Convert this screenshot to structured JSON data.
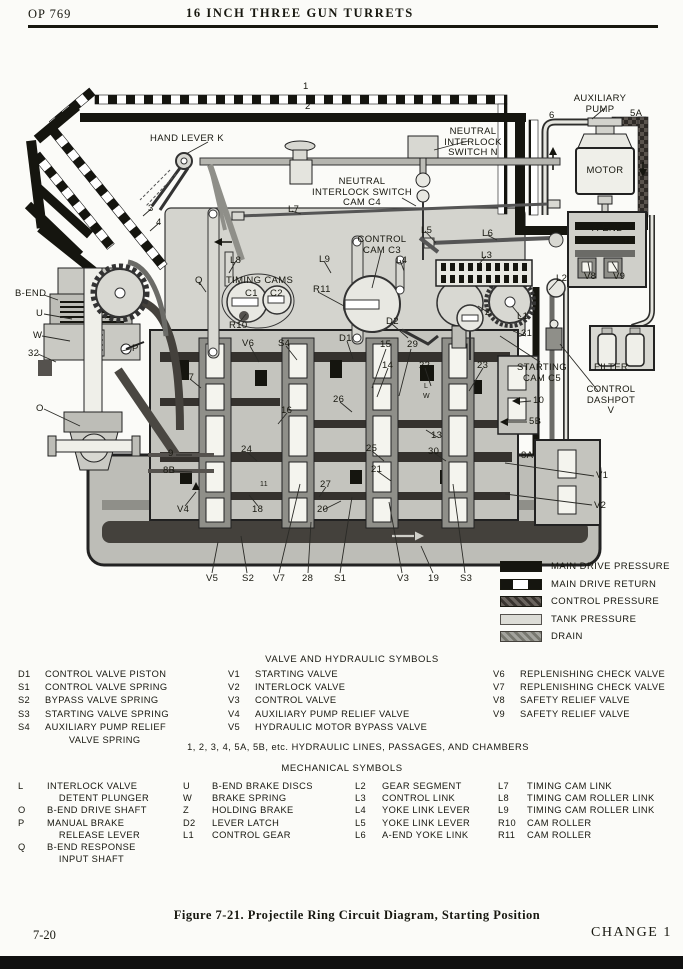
{
  "header": {
    "op_number": "OP 769",
    "title": "16 INCH THREE GUN TURRETS"
  },
  "diagram": {
    "labels": [
      {
        "id": "line-1",
        "t": "1",
        "x": 303,
        "y": 82
      },
      {
        "id": "line-2",
        "t": "2",
        "x": 305,
        "y": 102
      },
      {
        "id": "auxiliary-pump",
        "t": "AUXILIARY\nPUMP",
        "x": 600,
        "y": 94,
        "c": 1
      },
      {
        "id": "line-5a",
        "t": "5A",
        "x": 630,
        "y": 109
      },
      {
        "id": "line-6",
        "t": "6",
        "x": 549,
        "y": 111
      },
      {
        "id": "motor",
        "t": "MOTOR",
        "x": 605,
        "y": 166,
        "c": 1
      },
      {
        "id": "hand-lever-k",
        "t": "HAND LEVER K",
        "x": 150,
        "y": 134
      },
      {
        "id": "neutral-interlock-switch-n",
        "t": "NEUTRAL\nINTERLOCK\nSWITCH N",
        "x": 473,
        "y": 127,
        "c": 1
      },
      {
        "id": "neutral-interlock-switch-cam-c4",
        "t": "NEUTRAL\nINTERLOCK SWITCH\nCAM C4",
        "x": 362,
        "y": 177,
        "c": 1
      },
      {
        "id": "l7",
        "t": "L7",
        "x": 288,
        "y": 205
      },
      {
        "id": "line-3",
        "t": "3",
        "x": 148,
        "y": 204
      },
      {
        "id": "line-4",
        "t": "4",
        "x": 156,
        "y": 218
      },
      {
        "id": "l5",
        "t": "L5",
        "x": 421,
        "y": 226
      },
      {
        "id": "l6",
        "t": "L6",
        "x": 482,
        "y": 229
      },
      {
        "id": "control-cam-c3",
        "t": "CONTROL\nCAM C3",
        "x": 382,
        "y": 235,
        "c": 1
      },
      {
        "id": "l4",
        "t": "L4",
        "x": 396,
        "y": 256
      },
      {
        "id": "a-end",
        "t": "A-END",
        "x": 592,
        "y": 224
      },
      {
        "id": "h",
        "t": "H",
        "x": 624,
        "y": 237
      },
      {
        "id": "l8",
        "t": "L8",
        "x": 230,
        "y": 256
      },
      {
        "id": "l9",
        "t": "L9",
        "x": 319,
        "y": 255
      },
      {
        "id": "l3",
        "t": "L3",
        "x": 481,
        "y": 251
      },
      {
        "id": "b-end",
        "t": "B-END",
        "x": 15,
        "y": 289
      },
      {
        "id": "timing-cams",
        "t": "TIMING CAMS",
        "x": 226,
        "y": 276
      },
      {
        "id": "c1",
        "t": "C1",
        "x": 245,
        "y": 289
      },
      {
        "id": "c2",
        "t": "C2",
        "x": 270,
        "y": 289
      },
      {
        "id": "r11",
        "t": "R11",
        "x": 313,
        "y": 285
      },
      {
        "id": "q",
        "t": "Q",
        "x": 195,
        "y": 276
      },
      {
        "id": "r10",
        "t": "R10",
        "x": 229,
        "y": 321
      },
      {
        "id": "d2",
        "t": "D2",
        "x": 386,
        "y": 317
      },
      {
        "id": "l2",
        "t": "L2",
        "x": 556,
        "y": 274
      },
      {
        "id": "z",
        "t": "Z",
        "x": 485,
        "y": 308
      },
      {
        "id": "l1",
        "t": "L1",
        "x": 517,
        "y": 312
      },
      {
        "id": "v8",
        "t": "V8",
        "x": 584,
        "y": 272
      },
      {
        "id": "v9",
        "t": "V9",
        "x": 613,
        "y": 272
      },
      {
        "id": "u",
        "t": "U",
        "x": 36,
        "y": 309
      },
      {
        "id": "w",
        "t": "W",
        "x": 33,
        "y": 331
      },
      {
        "id": "num-32",
        "t": "32",
        "x": 28,
        "y": 349
      },
      {
        "id": "p",
        "t": "P",
        "x": 132,
        "y": 344
      },
      {
        "id": "o",
        "t": "O",
        "x": 36,
        "y": 404
      },
      {
        "id": "v6",
        "t": "V6",
        "x": 242,
        "y": 339
      },
      {
        "id": "s4",
        "t": "S4",
        "x": 278,
        "y": 339
      },
      {
        "id": "d1",
        "t": "D1",
        "x": 339,
        "y": 334
      },
      {
        "id": "num-15",
        "t": "15",
        "x": 380,
        "y": 340
      },
      {
        "id": "num-29",
        "t": "29",
        "x": 407,
        "y": 340
      },
      {
        "id": "num-14",
        "t": "14",
        "x": 382,
        "y": 361
      },
      {
        "id": "num-22",
        "t": "22",
        "x": 419,
        "y": 361
      },
      {
        "id": "num-23",
        "t": "23",
        "x": 477,
        "y": 361
      },
      {
        "id": "num-31",
        "t": "31",
        "x": 521,
        "y": 329
      },
      {
        "id": "starting-cam-c5",
        "t": "STARTING\nCAM C5",
        "x": 542,
        "y": 363,
        "c": 1
      },
      {
        "id": "filter",
        "t": "FILTER",
        "x": 594,
        "y": 363
      },
      {
        "id": "control-dashpot-v",
        "t": "CONTROL\nDASHPOT\nV",
        "x": 611,
        "y": 385,
        "c": 1
      },
      {
        "id": "num-26",
        "t": "26",
        "x": 333,
        "y": 395
      },
      {
        "id": "num-16",
        "t": "16",
        "x": 281,
        "y": 406
      },
      {
        "id": "num-10",
        "t": "10",
        "x": 533,
        "y": 396
      },
      {
        "id": "boxed-l",
        "t": "L",
        "x": 424,
        "y": 383,
        "s": 1
      },
      {
        "id": "boxed-w",
        "t": "W",
        "x": 423,
        "y": 393,
        "s": 1
      },
      {
        "id": "num-13",
        "t": "13",
        "x": 431,
        "y": 431
      },
      {
        "id": "line-5b",
        "t": "5B",
        "x": 529,
        "y": 417
      },
      {
        "id": "num-24",
        "t": "24",
        "x": 241,
        "y": 445
      },
      {
        "id": "num-25",
        "t": "25",
        "x": 366,
        "y": 444
      },
      {
        "id": "num-30",
        "t": "30",
        "x": 428,
        "y": 447
      },
      {
        "id": "num-21",
        "t": "21",
        "x": 371,
        "y": 465
      },
      {
        "id": "line-8a",
        "t": "8A",
        "x": 521,
        "y": 451
      },
      {
        "id": "v1",
        "t": "V1",
        "x": 596,
        "y": 471
      },
      {
        "id": "v2",
        "t": "V2",
        "x": 594,
        "y": 501
      },
      {
        "id": "num-17",
        "t": "17",
        "x": 183,
        "y": 373
      },
      {
        "id": "line-9",
        "t": "9",
        "x": 168,
        "y": 449
      },
      {
        "id": "line-8b",
        "t": "8B",
        "x": 163,
        "y": 466
      },
      {
        "id": "v4",
        "t": "V4",
        "x": 177,
        "y": 505
      },
      {
        "id": "num-18",
        "t": "18",
        "x": 252,
        "y": 505
      },
      {
        "id": "num-11",
        "t": "11",
        "x": 260,
        "y": 481,
        "s": 1
      },
      {
        "id": "num-27",
        "t": "27",
        "x": 320,
        "y": 480
      },
      {
        "id": "num-20",
        "t": "20",
        "x": 317,
        "y": 505
      },
      {
        "id": "v5",
        "t": "V5",
        "x": 206,
        "y": 574
      },
      {
        "id": "s2",
        "t": "S2",
        "x": 242,
        "y": 574
      },
      {
        "id": "v7",
        "t": "V7",
        "x": 273,
        "y": 574
      },
      {
        "id": "num-28",
        "t": "28",
        "x": 302,
        "y": 574
      },
      {
        "id": "s1",
        "t": "S1",
        "x": 334,
        "y": 574
      },
      {
        "id": "v3",
        "t": "V3",
        "x": 397,
        "y": 574
      },
      {
        "id": "num-19",
        "t": "19",
        "x": 428,
        "y": 574
      },
      {
        "id": "s3",
        "t": "S3",
        "x": 460,
        "y": 574
      }
    ]
  },
  "legend": {
    "items": [
      {
        "key": "main-drive-pressure",
        "label": "MAIN DRIVE PRESSURE"
      },
      {
        "key": "main-drive-return",
        "label": "MAIN DRIVE RETURN"
      },
      {
        "key": "control-pressure",
        "label": "CONTROL PRESSURE"
      },
      {
        "key": "tank-pressure",
        "label": "TANK PRESSURE"
      },
      {
        "key": "drain",
        "label": "DRAIN"
      }
    ]
  },
  "valve_symbols": {
    "heading": "VALVE AND HYDRAULIC SYMBOLS",
    "col1": [
      {
        "code": "D1",
        "desc": "CONTROL VALVE PISTON"
      },
      {
        "code": "S1",
        "desc": "CONTROL VALVE SPRING"
      },
      {
        "code": "S2",
        "desc": "BYPASS VALVE SPRING"
      },
      {
        "code": "S3",
        "desc": "STARTING VALVE SPRING"
      },
      {
        "code": "S4",
        "desc": "AUXILIARY PUMP RELIEF\n        VALVE SPRING"
      }
    ],
    "col2": [
      {
        "code": "V1",
        "desc": "STARTING VALVE"
      },
      {
        "code": "V2",
        "desc": "INTERLOCK VALVE"
      },
      {
        "code": "V3",
        "desc": "CONTROL VALVE"
      },
      {
        "code": "V4",
        "desc": "AUXILIARY PUMP RELIEF VALVE"
      },
      {
        "code": "V5",
        "desc": "HYDRAULIC MOTOR BYPASS VALVE"
      }
    ],
    "col3": [
      {
        "code": "V6",
        "desc": "REPLENISHING CHECK VALVE"
      },
      {
        "code": "V7",
        "desc": "REPLENISHING CHECK VALVE"
      },
      {
        "code": "V8",
        "desc": "SAFETY RELIEF VALVE"
      },
      {
        "code": "V9",
        "desc": "SAFETY RELIEF VALVE"
      }
    ]
  },
  "hydraulic_note": "1, 2, 3, 4, 5A, 5B, etc.   HYDRAULIC LINES, PASSAGES, AND CHAMBERS",
  "mechanical_symbols": {
    "heading": "MECHANICAL SYMBOLS",
    "col1": [
      {
        "code": "L",
        "desc": "INTERLOCK VALVE\n    DETENT PLUNGER"
      },
      {
        "code": "O",
        "desc": "B-END DRIVE SHAFT"
      },
      {
        "code": "P",
        "desc": "MANUAL BRAKE\n    RELEASE LEVER"
      },
      {
        "code": "Q",
        "desc": "B-END RESPONSE\n    INPUT SHAFT"
      }
    ],
    "col2": [
      {
        "code": "U",
        "desc": "B-END BRAKE DISCS"
      },
      {
        "code": "W",
        "desc": "BRAKE SPRING"
      },
      {
        "code": "Z",
        "desc": "HOLDING BRAKE"
      },
      {
        "code": "D2",
        "desc": "LEVER LATCH"
      },
      {
        "code": "L1",
        "desc": "CONTROL GEAR"
      }
    ],
    "col3": [
      {
        "code": "L2",
        "desc": "GEAR SEGMENT"
      },
      {
        "code": "L3",
        "desc": "CONTROL LINK"
      },
      {
        "code": "L4",
        "desc": "YOKE LINK LEVER"
      },
      {
        "code": "L5",
        "desc": "YOKE LINK LEVER"
      },
      {
        "code": "L6",
        "desc": "A-END YOKE LINK"
      }
    ],
    "col4": [
      {
        "code": "L7",
        "desc": "TIMING CAM LINK"
      },
      {
        "code": "L8",
        "desc": "TIMING CAM ROLLER LINK"
      },
      {
        "code": "L9",
        "desc": "TIMING CAM ROLLER LINK"
      },
      {
        "code": "R10",
        "desc": "CAM ROLLER"
      },
      {
        "code": "R11",
        "desc": "CAM ROLLER"
      }
    ]
  },
  "caption": "Figure 7-21.  Projectile Ring Circuit Diagram, Starting Position",
  "footer": {
    "page": "7-20",
    "change": "CHANGE 1"
  }
}
